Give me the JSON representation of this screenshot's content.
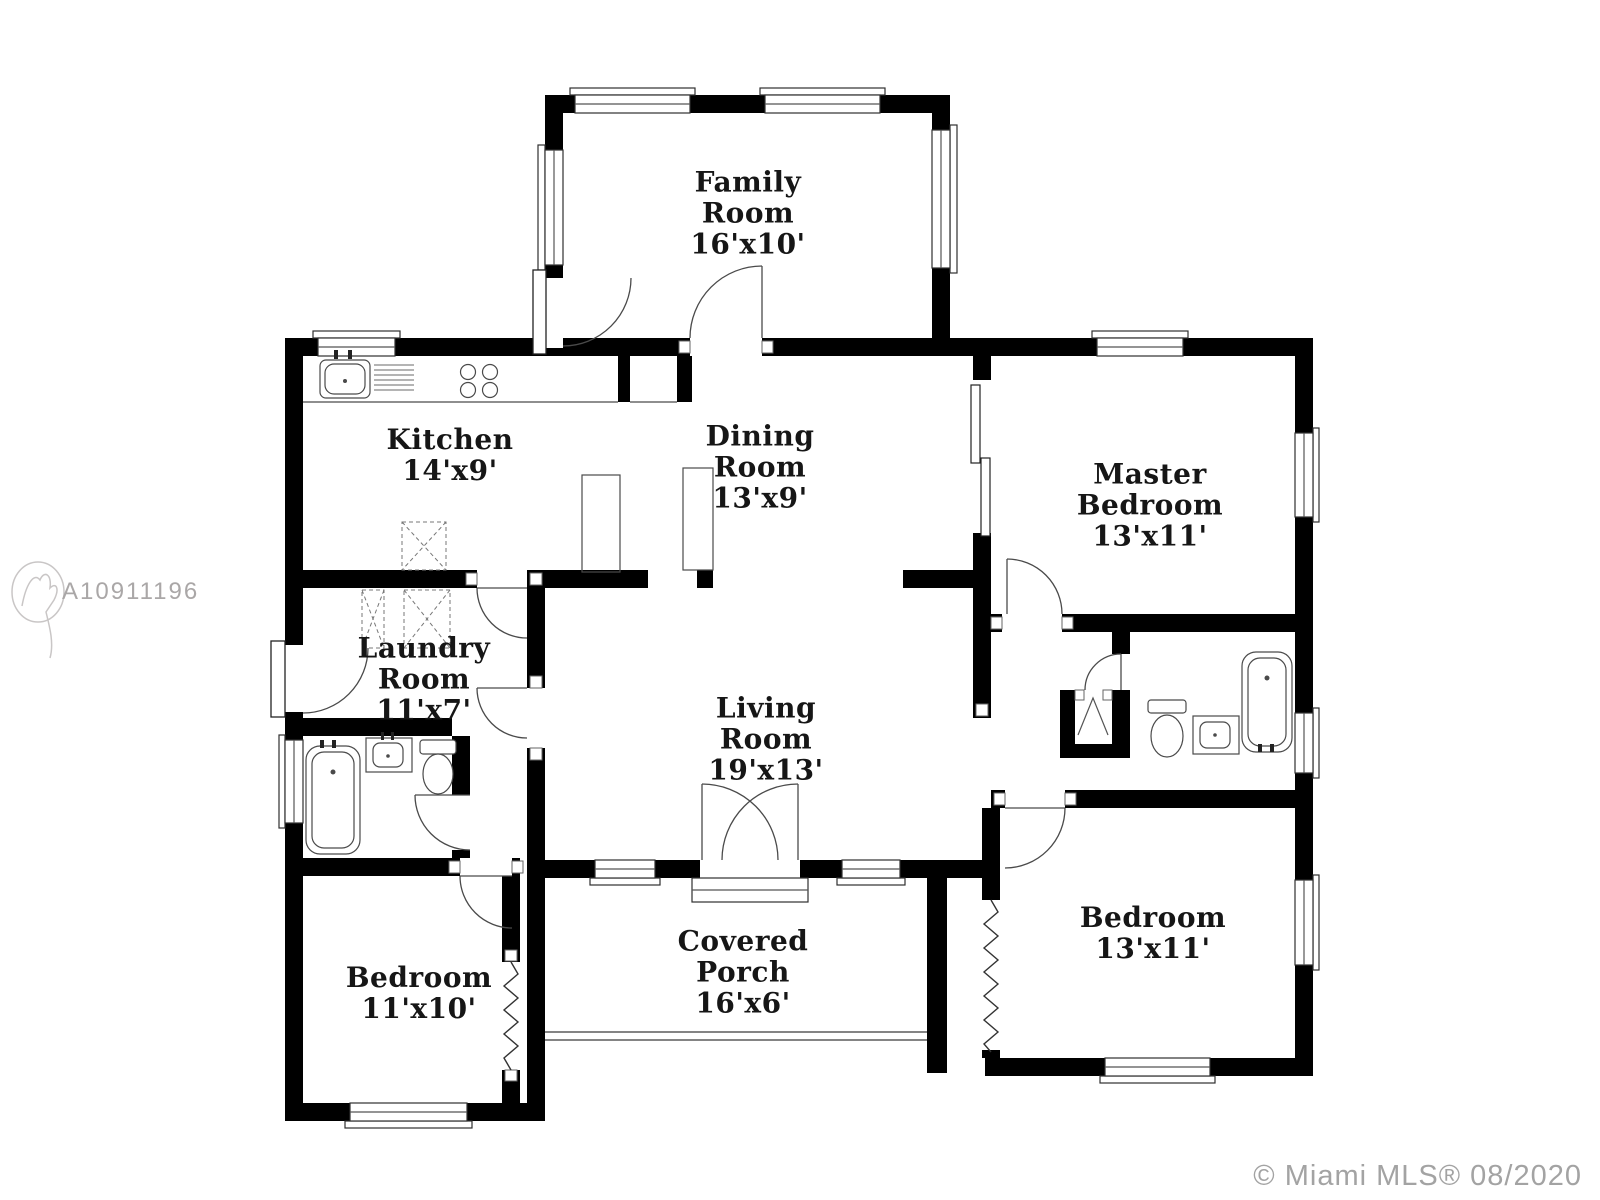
{
  "watermark": {
    "id": "A10911196"
  },
  "footer": {
    "copyright": "© Miami MLS® 08/2020"
  },
  "colors": {
    "wall": "#000000",
    "fixture_line": "#4a4a4a",
    "watermark_gray": "#aaa7a7",
    "copyright_gray": "#a3a3a3"
  },
  "rooms": {
    "family": {
      "line1": "Family",
      "line2": "Room",
      "dims": "16'x10'"
    },
    "kitchen": {
      "line1": "Kitchen",
      "dims": "14'x9'"
    },
    "dining": {
      "line1": "Dining",
      "line2": "Room",
      "dims": "13'x9'"
    },
    "master": {
      "line1": "Master",
      "line2": "Bedroom",
      "dims": "13'x11'"
    },
    "laundry": {
      "line1": "Laundry",
      "line2": "Room",
      "dims": "11'x7'"
    },
    "living": {
      "line1": "Living",
      "line2": "Room",
      "dims": "19'x13'"
    },
    "bedroom_left": {
      "line1": "Bedroom",
      "dims": "11'x10'"
    },
    "porch": {
      "line1": "Covered",
      "line2": "Porch",
      "dims": "16'x6'"
    },
    "bedroom_right": {
      "line1": "Bedroom",
      "dims": "13'x11'"
    }
  }
}
